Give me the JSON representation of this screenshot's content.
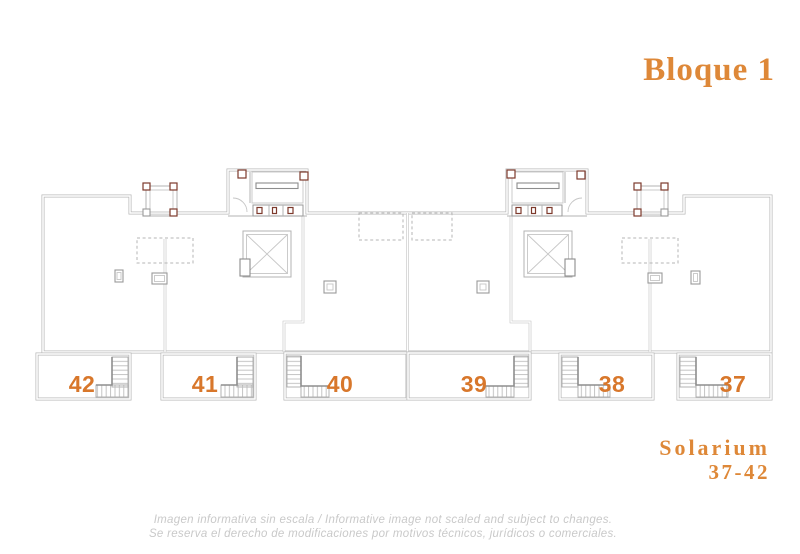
{
  "title": "Bloque 1",
  "plan": {
    "units": [
      {
        "number": "42"
      },
      {
        "number": "41"
      },
      {
        "number": "40"
      },
      {
        "number": "39"
      },
      {
        "number": "38"
      },
      {
        "number": "37"
      }
    ]
  },
  "floor_label": {
    "name": "Solarium",
    "range": "37-42"
  },
  "disclaimer": {
    "line1": "Imagen informativa sin escala /  Informative image not scaled and subject to changes.",
    "line2": "Se reserva el derecho de modificaciones por motivos técnicos, jurídicos o comerciales."
  },
  "colors": {
    "accent_orange": "#DE8838",
    "unit_number_orange": "#D8772B",
    "wall_gray": "#B9B9B9",
    "detail_maroon": "#7D3A2C",
    "disclaimer_gray": "#C9C9C9"
  }
}
